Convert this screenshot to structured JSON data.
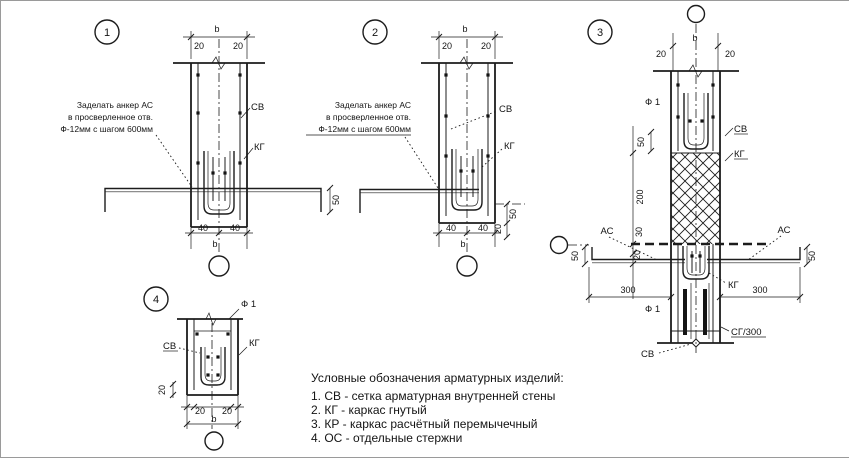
{
  "badges": {
    "d1": "1",
    "d2": "2",
    "d3": "3",
    "d4": "4"
  },
  "labels": {
    "cb": "СВ",
    "kg": "КГ",
    "ac": "АС",
    "f1": "Ф 1",
    "sg300": "СГ/300",
    "b": "b"
  },
  "dims": {
    "d20": "20",
    "d30": "30",
    "d40": "40",
    "d50": "50",
    "d200": "200",
    "d300": "300"
  },
  "notes": {
    "d1": {
      "line1": "Заделать анкер АС",
      "line2": "в просверленное отв.",
      "line3": "Ф-12мм с шагом 600мм"
    },
    "d2": {
      "line1": "Заделать анкер АС",
      "line2": "в просверленное отв.",
      "line3": "Ф-12мм с шагом 600мм"
    }
  },
  "legend": {
    "title": "Условные обозначения арматурных изделий:",
    "items": [
      {
        "label": "1. СВ - сетка арматурная внутренней стены"
      },
      {
        "label": "2. КГ - каркас гнутый"
      },
      {
        "label": "3. КР - каркас расчётный перемычечный"
      },
      {
        "label": "4. ОС - отдельные стержни"
      }
    ]
  }
}
